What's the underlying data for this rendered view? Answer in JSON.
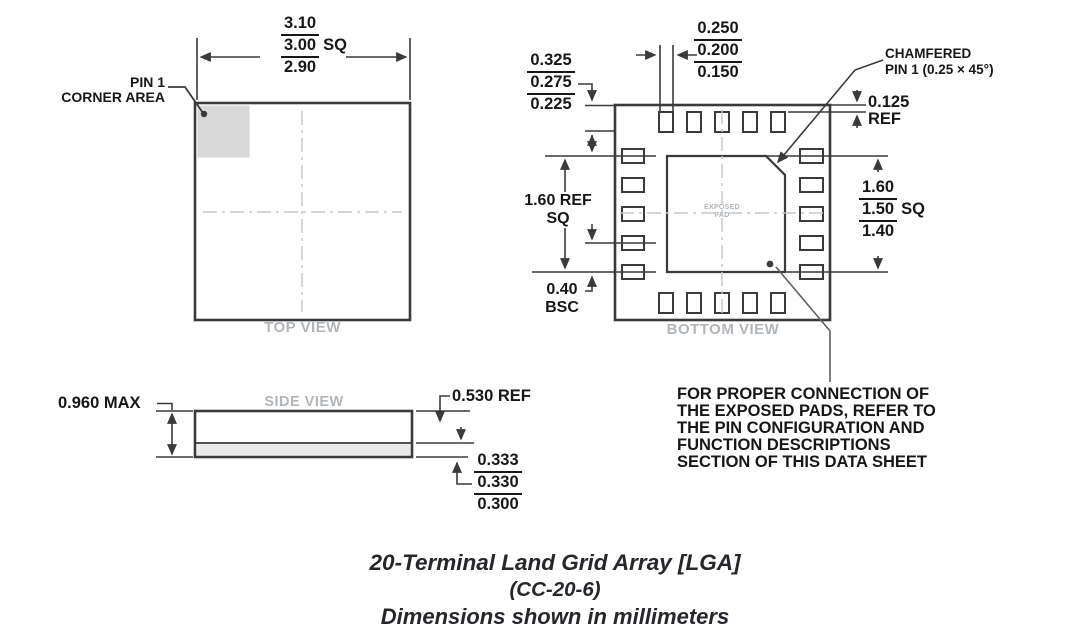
{
  "top_view": {
    "label": "TOP VIEW",
    "pin1_line1": "PIN 1",
    "pin1_line2": "CORNER AREA",
    "size": {
      "max": "3.10",
      "nom": "3.00",
      "suffix": "SQ",
      "min": "2.90"
    }
  },
  "bottom_view": {
    "label": "BOTTOM VIEW",
    "exposed_pad": {
      "line1": "EXPOSED",
      "line2": "PAD"
    },
    "edge_margin": {
      "max": "0.325",
      "nom": "0.275",
      "min": "0.225"
    },
    "pad_width": {
      "max": "0.250",
      "nom": "0.200",
      "min": "0.150"
    },
    "chamfer": {
      "line1": "CHAMFERED",
      "line2": "PIN 1 (0.25 × 45°)"
    },
    "corner_gap": {
      "value": "0.125",
      "ref": "REF"
    },
    "exposed_size": {
      "max": "1.60",
      "nom": "1.50",
      "suffix": "SQ",
      "min": "1.40"
    },
    "pad_span": {
      "line1": "1.60 REF",
      "line2": "SQ"
    },
    "pitch": {
      "line1": "0.40",
      "line2": "BSC"
    }
  },
  "side_view": {
    "label": "SIDE VIEW",
    "height_max": "0.960 MAX",
    "body_ref": "0.530 REF",
    "standoff": {
      "max": "0.333",
      "nom": "0.330",
      "min": "0.300"
    }
  },
  "note": {
    "lines": [
      "FOR PROPER CONNECTION OF",
      "THE EXPOSED PADS, REFER TO",
      "THE PIN CONFIGURATION AND",
      "FUNCTION DESCRIPTIONS",
      "SECTION OF THIS DATA SHEET"
    ]
  },
  "caption": {
    "line1": "20-Terminal Land Grid Array [LGA]",
    "line2": "(CC-20-6)",
    "line3": "Dimensions shown in millimeters"
  },
  "colors": {
    "line": "#3a3a3a",
    "text": "#17171a",
    "muted": "#b2b6ba",
    "shade": "#d8d8d8",
    "strip": "#e9e9e9"
  }
}
